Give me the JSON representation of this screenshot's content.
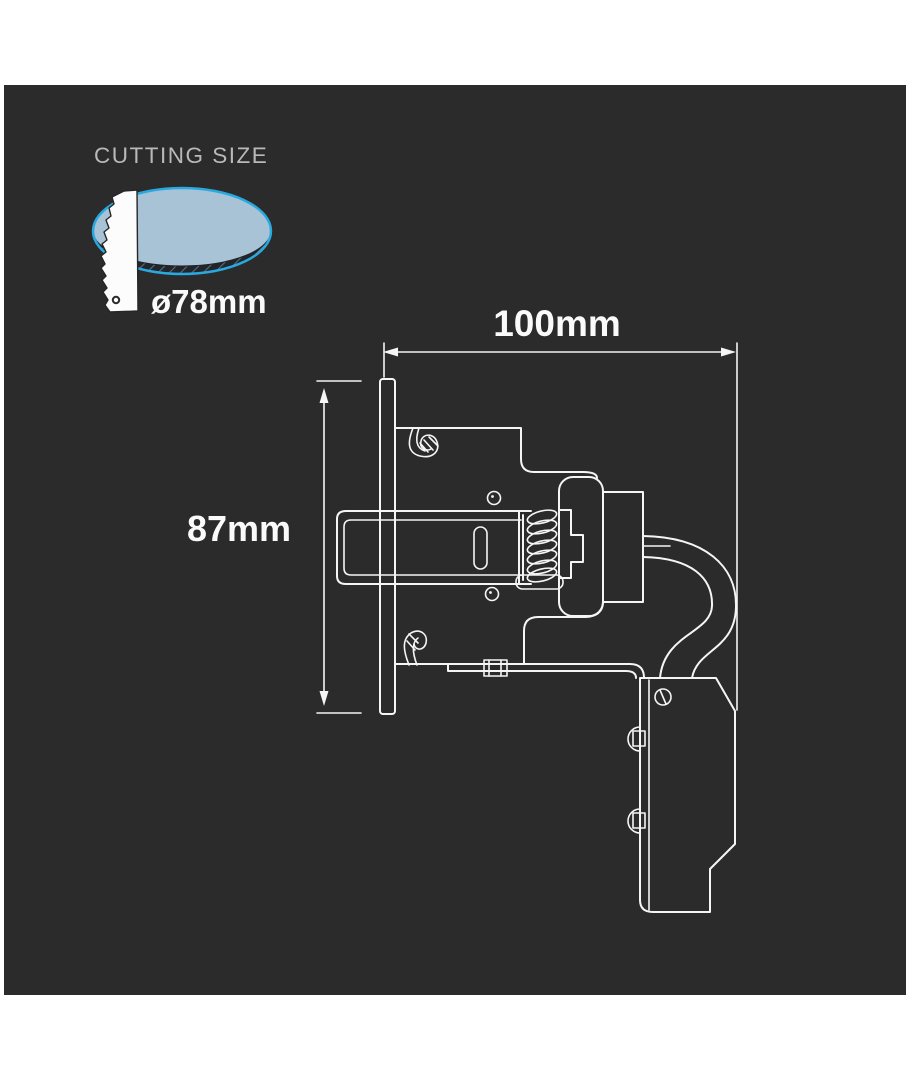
{
  "product_diagram": {
    "cutting_size": {
      "label": "CUTTING SIZE",
      "diameter": "ø78mm"
    },
    "dimensions": {
      "width": "100mm",
      "height": "87mm"
    },
    "colors": {
      "page_background": "#ffffff",
      "panel_background": "#2b2b2b",
      "drawing_line": "#f5f5f5",
      "accent_cyan": "#2aa9e0",
      "cut_hole_fill": "#a8c3d6",
      "muted_label_text": "#b9b9b9"
    },
    "icons": {
      "cut_hole": "cut-hole-ellipse-icon",
      "saw_blade": "saw-blade-icon"
    }
  }
}
